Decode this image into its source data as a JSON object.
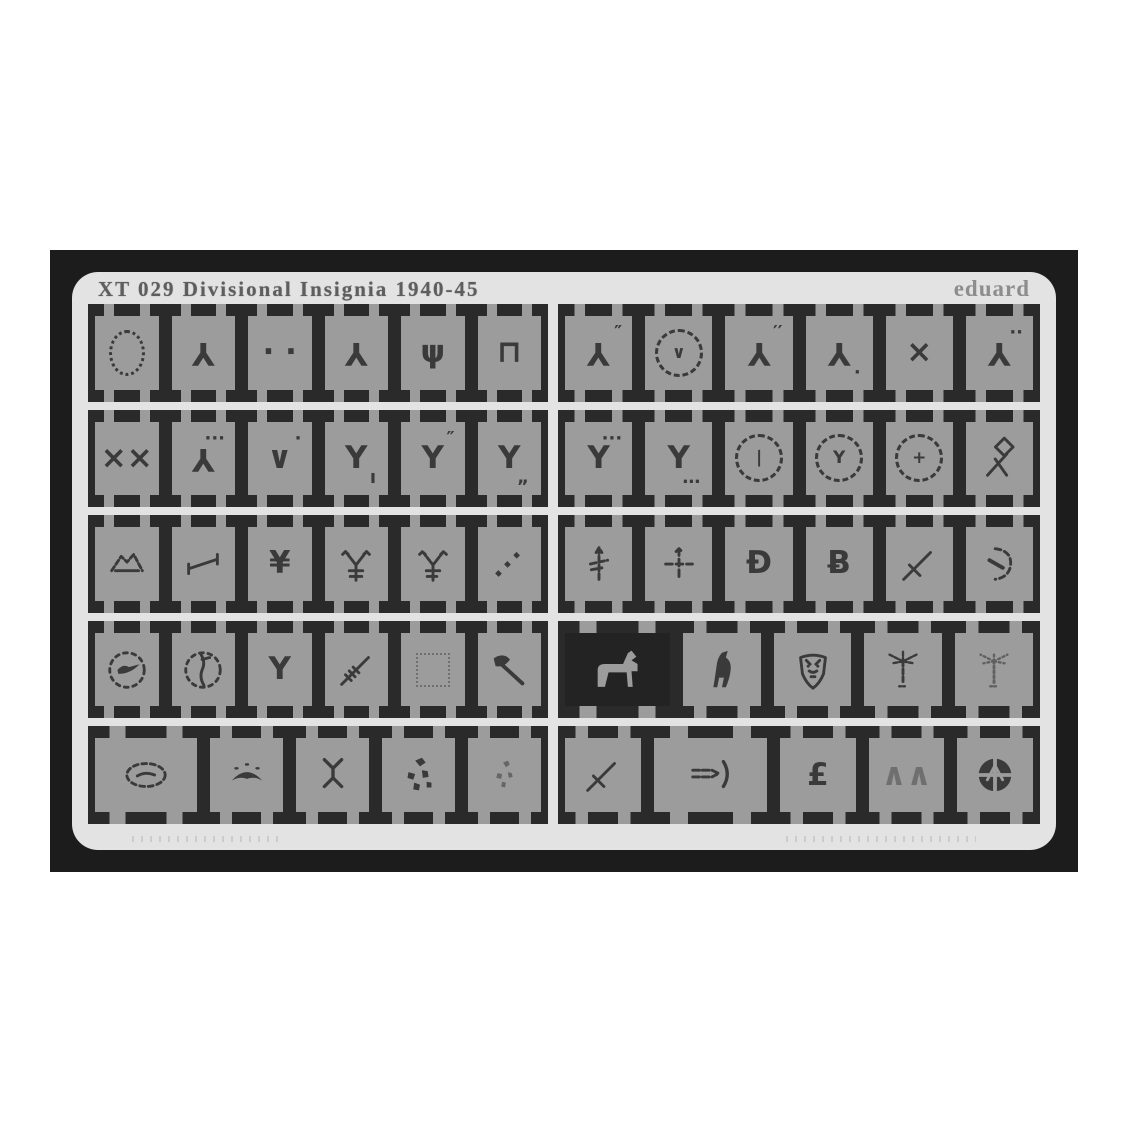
{
  "sheet": {
    "title": "XT 029  Divisional Insignia 1940-45",
    "brand": "eduard",
    "frame_color": "#1c1c1c",
    "sheet_color": "#e3e3e3",
    "etch_color": "#2a2a2a",
    "part_color": "#9c9c9c",
    "symbol_color": "#3a3a3a",
    "recessed_color": "#232323"
  },
  "panels": {
    "left": {
      "rows": [
        [
          "laurel-wreath",
          "y-inverted",
          "two-dots",
          "y-inverted",
          "trident",
          "table-stand"
        ],
        [
          "double-x",
          "y-inverted-3dots",
          "check-dot",
          "y-tick",
          "y-2ticks",
          "y-2ticks-low"
        ],
        [
          "mountain",
          "lever",
          "y-crossbar",
          "y-arrow-cross",
          "y-arrow-cross-dashed",
          "diagonal-dashes"
        ],
        [
          "bird-circle",
          "monogram-circle",
          "y-plain",
          "sword-hatched",
          "faint-outline",
          "axe"
        ],
        [
          {
            "icon": "fish-oval",
            "w": 1.4
          },
          "manta",
          "y-x",
          "splatter-large",
          "splatter-small"
        ]
      ]
    },
    "right": {
      "rows": [
        [
          "y-inverted-2ticks",
          "dotted-circle-check",
          "y-inverted-ticks",
          "y-inverted-dot",
          "x-single",
          "y-inverted-2dots"
        ],
        [
          "y-3dots",
          "y-3ticks-low",
          "circle-bar",
          "circle-y",
          "circle-cross",
          "diamond-staves"
        ],
        [
          "sword-up",
          "cross-arrow",
          "bow-d",
          "bow-b",
          "sword-slant",
          "dashed-hook"
        ],
        [
          {
            "icon": "horse",
            "dark": true,
            "w": 1.35
          },
          "bear",
          "bull-shield",
          "palm-dashed",
          "palm-dotted"
        ],
        [
          "sword-slant",
          {
            "icon": "crossbow",
            "w": 1.5
          },
          "pound",
          "faint-dashes",
          "wheel"
        ]
      ]
    }
  }
}
